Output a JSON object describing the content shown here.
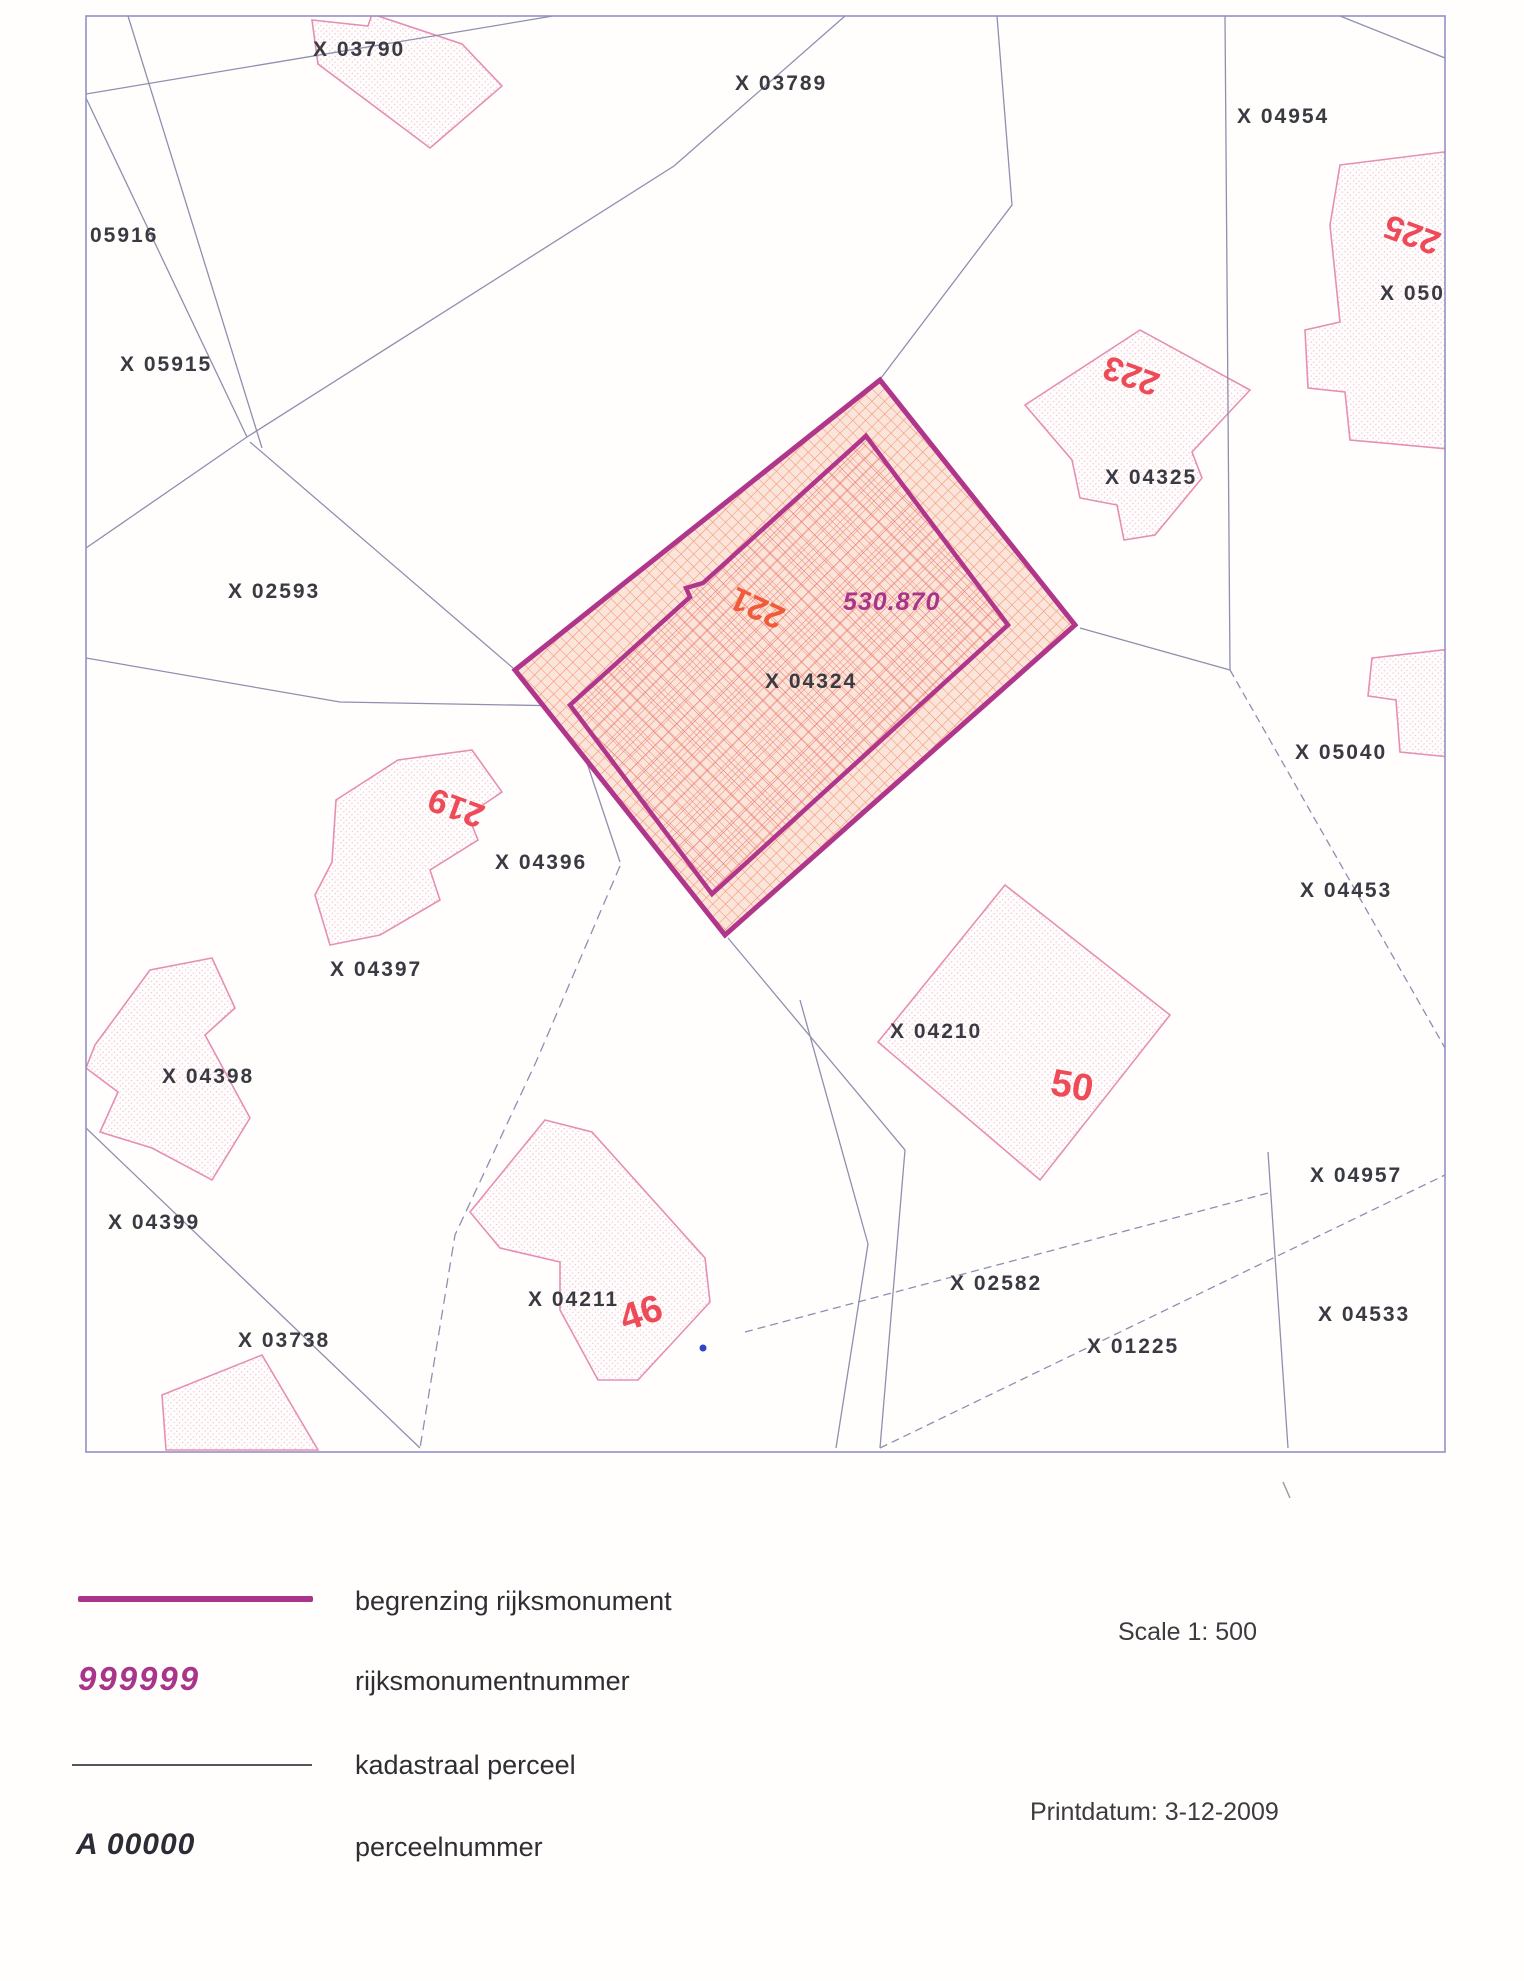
{
  "map": {
    "parcel_labels": [
      "X 03790",
      "X 03789",
      "X 04954",
      "05916",
      "X 05915",
      "X 02593",
      "X 04325",
      "X 04324",
      "X 05040",
      "X 04396",
      "X 04453",
      "X 04397",
      "X 04210",
      "X 04398",
      "X 04957",
      "X 04399",
      "X 02582",
      "X 04533",
      "X 04211",
      "X 03738",
      "X 01225",
      "X 0501"
    ],
    "house_numbers": [
      "225",
      "223",
      "221",
      "219",
      "50",
      "46"
    ],
    "monument": {
      "rijksmonument_number": "530.870",
      "parcel": "X 04324",
      "boundary_color": "#b0368c",
      "hatch_color": "#ef8266"
    },
    "colors": {
      "map_border": "#9191c8",
      "parcel_line": "#8f8fae",
      "building_outline": "#e58fb4",
      "house_number": "#ee4a58",
      "label_text": "#3a3a42"
    }
  },
  "legend": {
    "items": [
      {
        "key": "boundary-sample",
        "label": "begrenzing rijksmonument"
      },
      {
        "key": "monument-number-sample",
        "sample": "999999",
        "label": "rijksmonumentnummer"
      },
      {
        "key": "cadastral-line-sample",
        "label": "kadastraal perceel"
      },
      {
        "key": "parcel-number-sample",
        "sample": "A 00000",
        "label": "perceelnummer"
      }
    ],
    "scale": "Scale 1: 500",
    "print_date": "Printdatum: 3-12-2009"
  }
}
